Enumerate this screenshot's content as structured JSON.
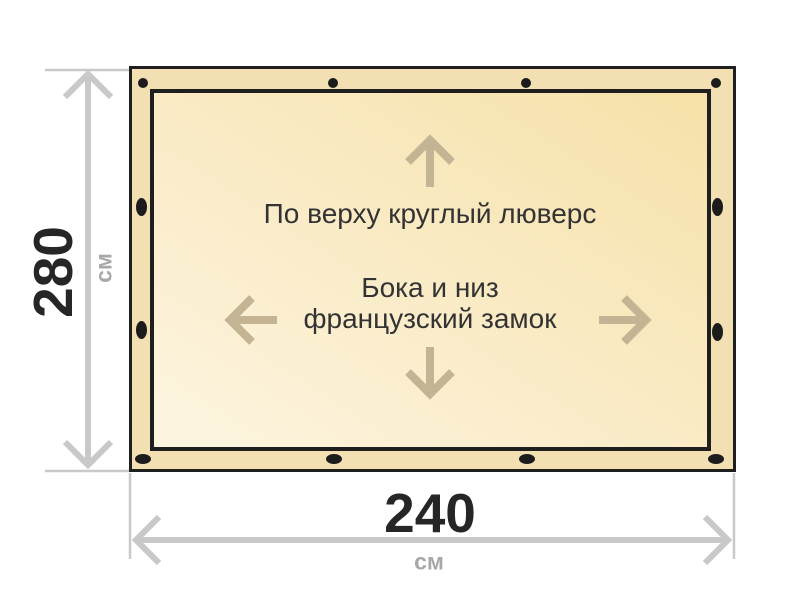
{
  "diagram": {
    "title_semantic": "tarp-specification-diagram",
    "notes": {
      "top": "По верху круглый люверс",
      "middle_line1": "Бока и низ",
      "middle_line2": "французский замок"
    },
    "dimensions": {
      "height": {
        "value": "280",
        "unit": "см"
      },
      "width": {
        "value": "240",
        "unit": "см"
      }
    },
    "icons": [
      "up-arrow-icon",
      "down-arrow-icon",
      "left-arrow-icon",
      "right-arrow-icon",
      "grommet-dot-icon"
    ],
    "colors": {
      "outline": "#1f1f1f",
      "hem_band": "#f2dfb2",
      "fill_gradient_start": "#fdf5e1",
      "fill_gradient_end": "#f6e1a8",
      "grommet": "#1c1c1c",
      "direction_arrow": "#c3b493",
      "dimension_line": "#c9c9c9",
      "note_text": "#333333",
      "dimension_value_text": "#262626",
      "dimension_unit_text": "#a8a8a8"
    }
  }
}
